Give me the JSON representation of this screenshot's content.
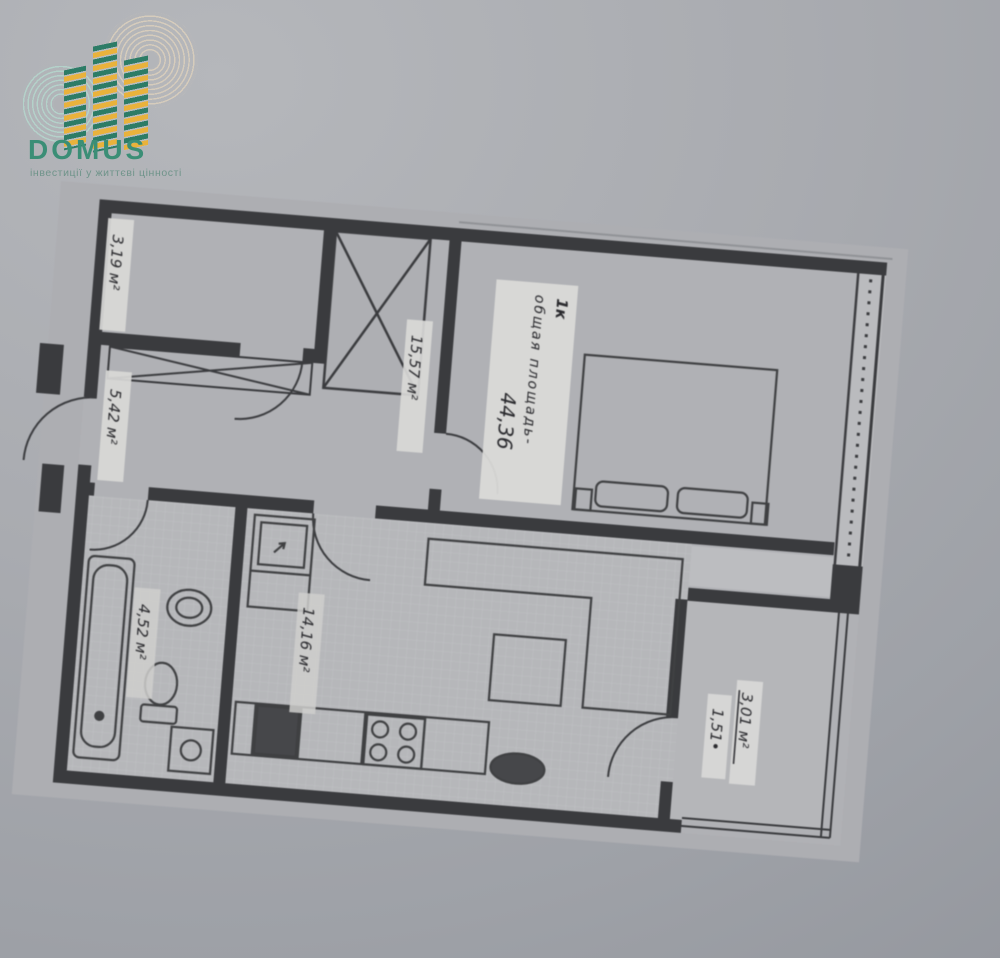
{
  "logo": {
    "brand": "DOMUS",
    "tagline": "інвестиції у життєві цінності",
    "colors": {
      "green": "#3b8e76",
      "yellow": "#e9b23c",
      "teal_ring": "#b4d2ca",
      "beige_ring": "#d6ccbc"
    }
  },
  "plan": {
    "summary": {
      "type_label": "1к",
      "area_caption": "общая площадь-",
      "area_value": "44,36"
    },
    "rooms": {
      "wardrobe": {
        "area": "3,19 м²"
      },
      "hallway": {
        "area": "5,42 м²"
      },
      "bedroom": {
        "area": "15,57 м²"
      },
      "bathroom": {
        "area": "4,52 м²"
      },
      "kitchen": {
        "area": "14,16 м²"
      },
      "balcony": {
        "area_total": "3,01 м²",
        "area_reduced": "1,51•"
      }
    }
  }
}
